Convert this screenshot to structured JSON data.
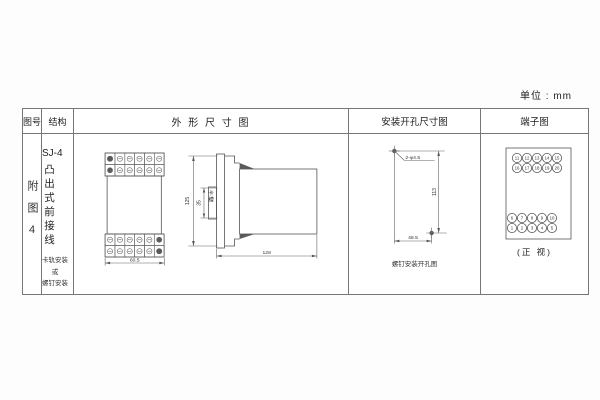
{
  "unit_label": "单位 : mm",
  "table": {
    "headers": {
      "col1": "图号",
      "col2": "结构",
      "col3": "外 形 尺 寸 图",
      "col4": "安装开孔尺寸图",
      "col5": "端子图"
    }
  },
  "figure_no": "附图4",
  "structure": {
    "model": "SJ-4",
    "type_vertical": "凸出式前接线",
    "mount_lines": [
      "卡轨安装",
      "或",
      "螺钉安装"
    ]
  },
  "outline_drawing": {
    "front_width": "60.5",
    "height": "125",
    "slot_dim": "35",
    "slot_label": "卡槽",
    "depth": "128"
  },
  "mounting_drawing": {
    "holes_label": "2-φ4.5",
    "vertical_dim": "113",
    "horizontal_dim": "48.5",
    "caption": "螺钉安装开孔图"
  },
  "terminals": {
    "row1": [
      "11",
      "12",
      "13",
      "14",
      "15"
    ],
    "row2": [
      "16",
      "17",
      "18",
      "19",
      "20"
    ],
    "row3": [
      "6",
      "7",
      "8",
      "9",
      "10"
    ],
    "row4": [
      "1",
      "2",
      "3",
      "4",
      "5"
    ],
    "caption": "(正 视)"
  }
}
